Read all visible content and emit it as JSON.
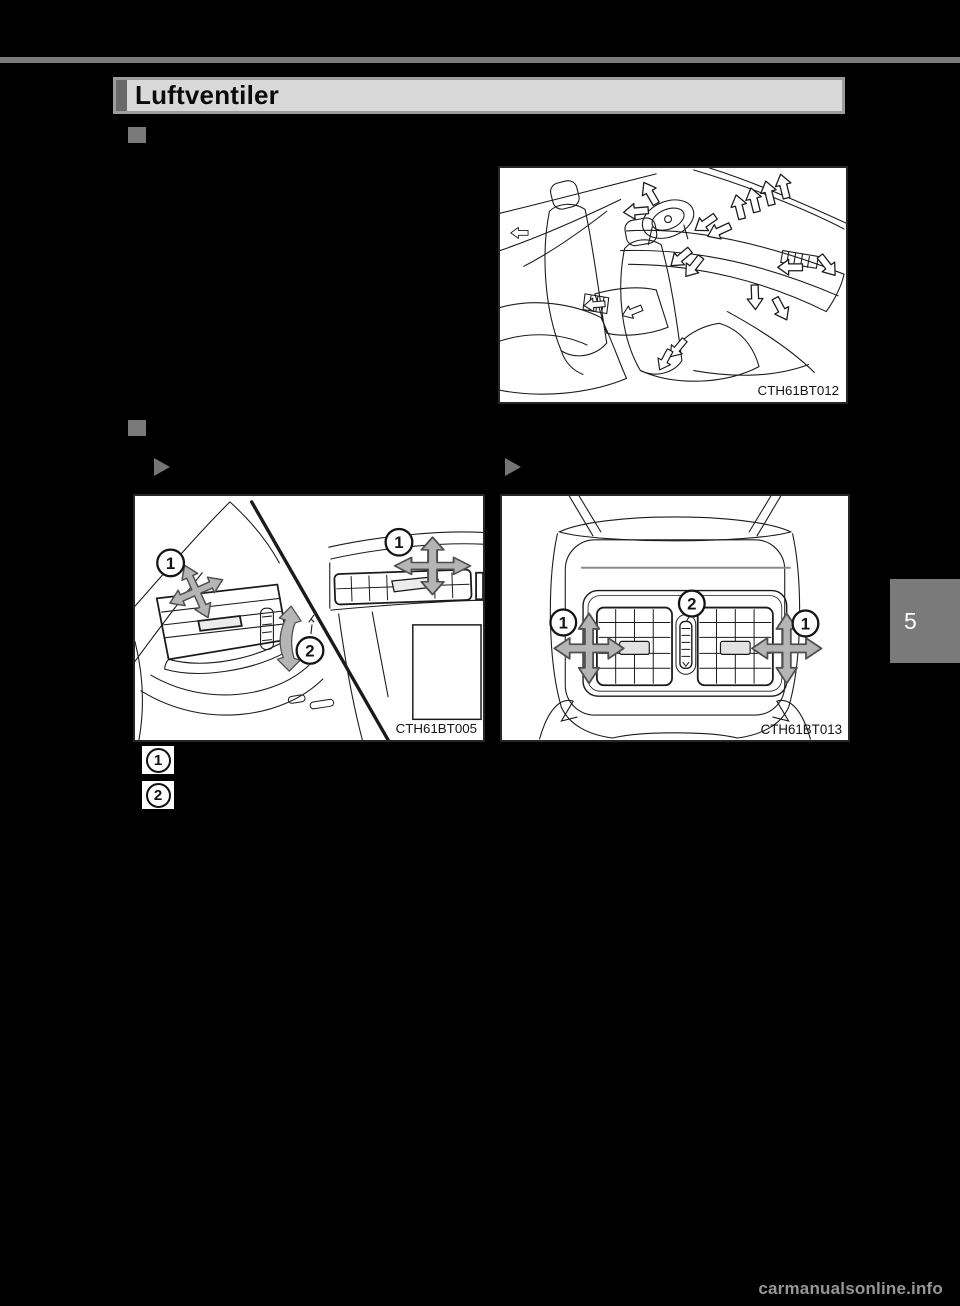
{
  "page": {
    "background_color": "#000000",
    "top_rule_color": "#7b7b7b",
    "tab_number": "5",
    "watermark": "carmanualsonline.info"
  },
  "header": {
    "title": "Luftventiler",
    "bar_color": "#d9d9d9",
    "accent_color": "#696969",
    "frame_color": "#9c9c9c"
  },
  "figures": {
    "overview": {
      "caption": "CTH61BT012"
    },
    "front": {
      "caption": "CTH61BT005",
      "callout1": "1",
      "callout2": "2"
    },
    "rear": {
      "caption": "CTH61BT013",
      "callout1": "1",
      "callout2": "2"
    }
  },
  "legend": {
    "item1": "1",
    "item2": "2"
  },
  "colors": {
    "bullet_gray": "#7a7a7a",
    "marker_gray": "#757575",
    "arrow_fill": "#b5b5b5",
    "watermark_gray": "#969696"
  }
}
